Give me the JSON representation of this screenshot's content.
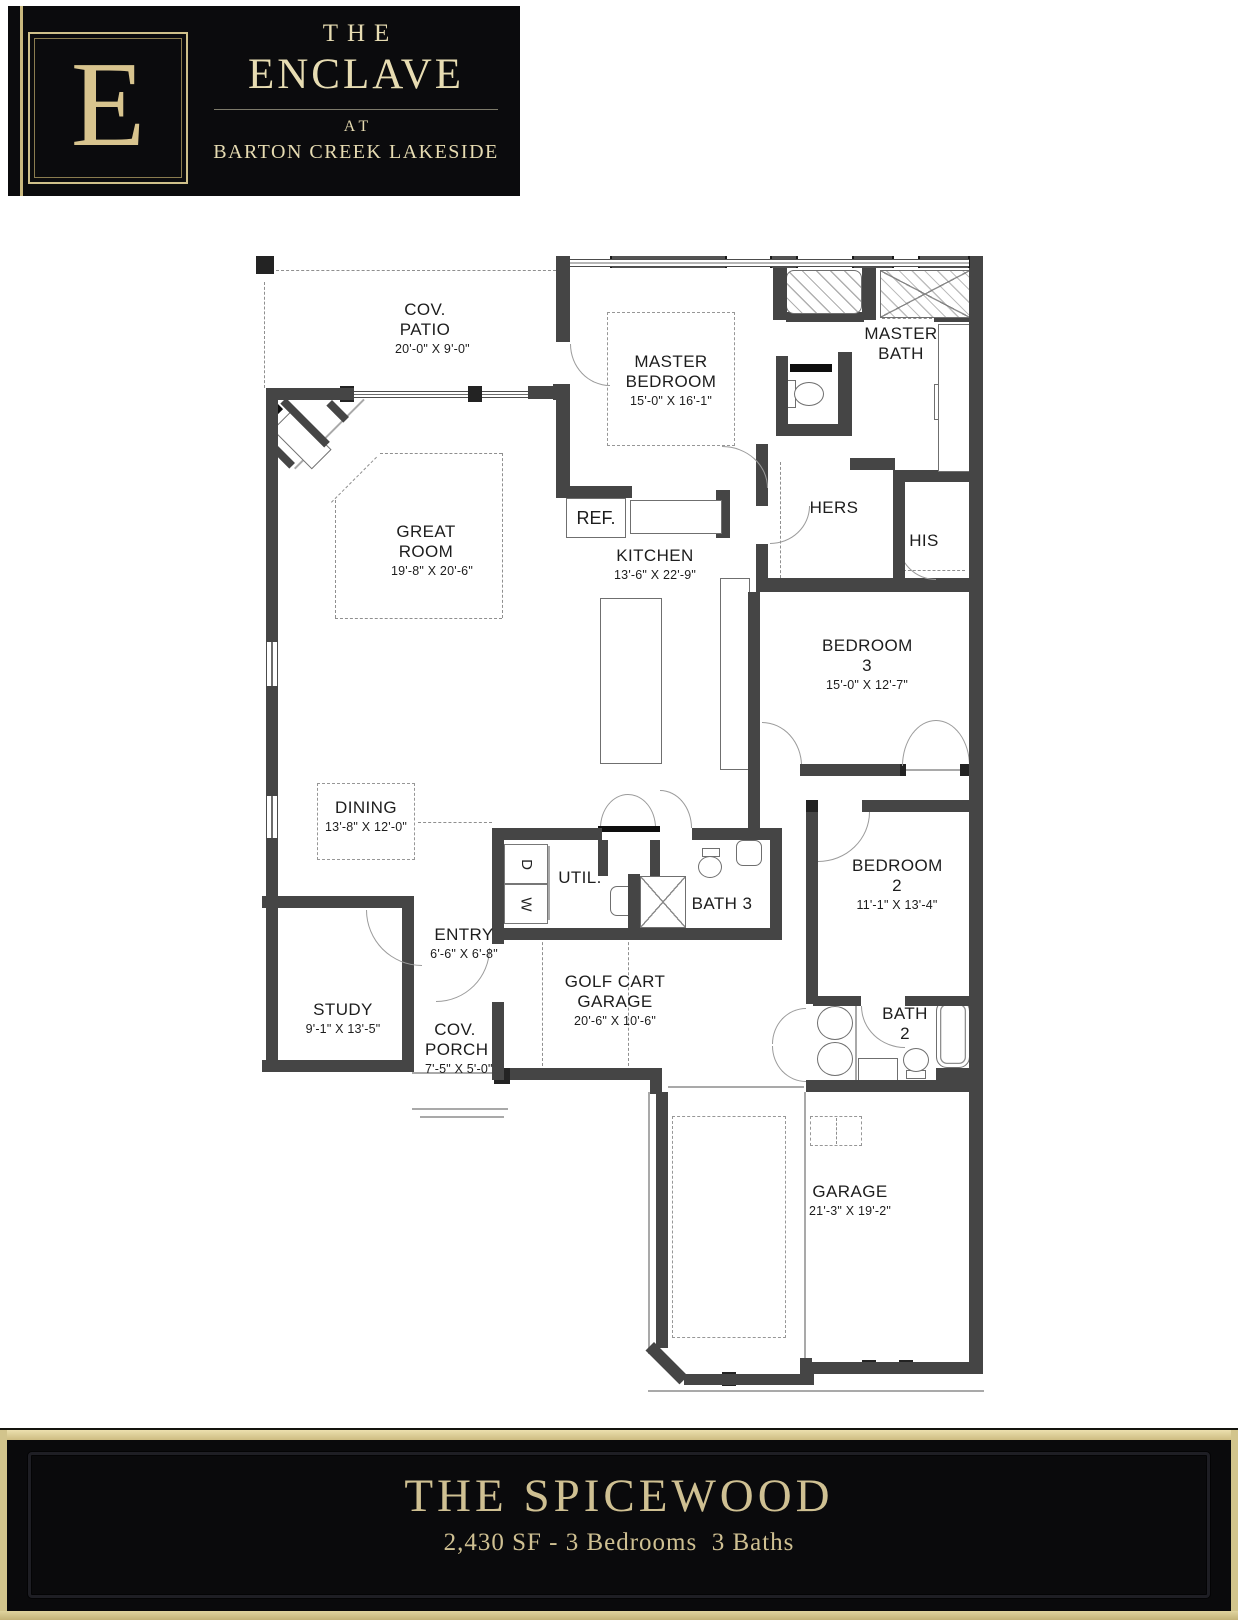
{
  "logo": {
    "monogram": "E",
    "title_line1": "THE",
    "title_line2": "ENCLAVE",
    "subtitle_line1": "AT",
    "subtitle_line2": "BARTON CREEK LAKESIDE"
  },
  "banner": {
    "title": "THE SPICEWOOD",
    "subtitle": "2,430 SF - 3 Bedrooms  3 Baths"
  },
  "rooms": {
    "cov_patio": {
      "label": "COV. PATIO",
      "dims": "20'-0\" X 9'-0\""
    },
    "master_bedroom": {
      "label": "MASTER BEDROOM",
      "dims": "15'-0\" X 16'-1\""
    },
    "master_bath": {
      "label": "MASTER BATH"
    },
    "hers": {
      "label": "HERS"
    },
    "his": {
      "label": "HIS"
    },
    "great_room": {
      "label": "GREAT ROOM",
      "dims": "19'-8\" X 20'-6\""
    },
    "kitchen": {
      "label": "KITCHEN",
      "dims": "13'-6\" X 22'-9\""
    },
    "ref": {
      "label": "REF."
    },
    "bedroom3": {
      "label": "BEDROOM 3",
      "dims": "15'-0\" X 12'-7\""
    },
    "dining": {
      "label": "DINING",
      "dims": "13'-8\" X 12'-0\""
    },
    "util": {
      "label": "UTIL."
    },
    "washer": {
      "label": "W"
    },
    "dryer": {
      "label": "D"
    },
    "bath3": {
      "label": "BATH 3"
    },
    "bedroom2": {
      "label": "BEDROOM 2",
      "dims": "11'-1\" X 13'-4\""
    },
    "bath2": {
      "label": "BATH 2"
    },
    "entry": {
      "label": "ENTRY",
      "dims": "6'-6\" X 6'-8\""
    },
    "study": {
      "label": "STUDY",
      "dims": "9'-1\" X 13'-5\""
    },
    "cov_porch": {
      "label": "COV. PORCH",
      "dims": "7'-5\" X 5'-0\""
    },
    "golf_cart_garage": {
      "label": "GOLF CART GARAGE",
      "dims": "20'-6\" X 10'-6\""
    },
    "garage": {
      "label": "GARAGE",
      "dims": "21'-3\" X 19'-2\""
    }
  }
}
